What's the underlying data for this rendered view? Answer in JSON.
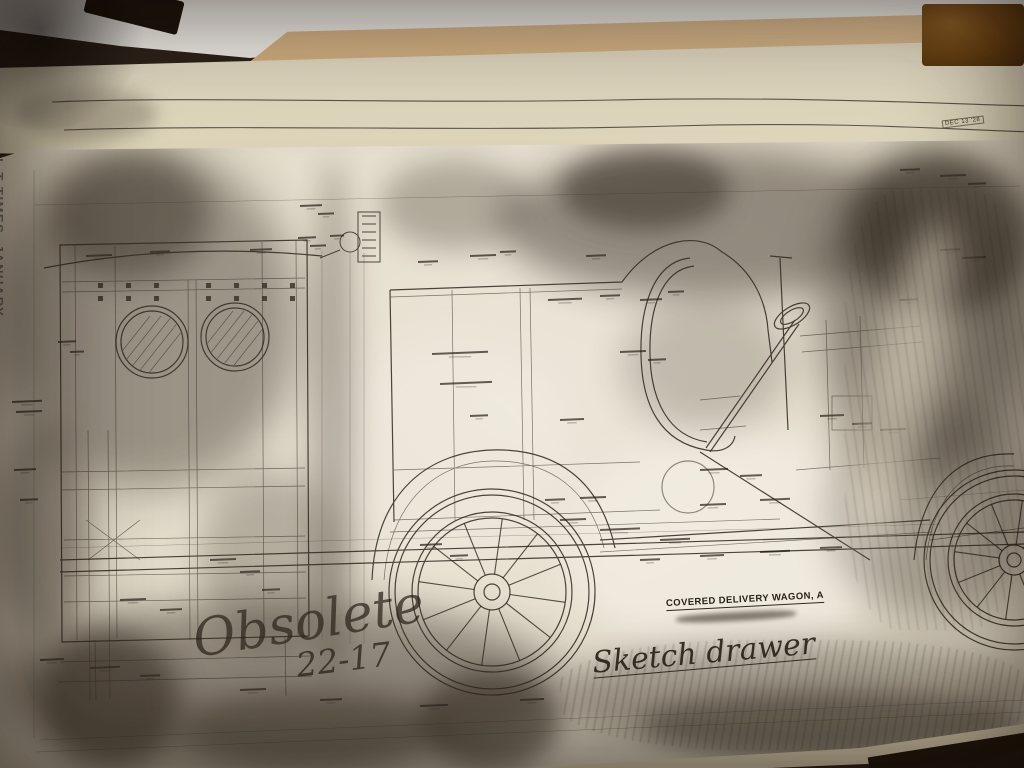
{
  "texts": {
    "page_margin_vertical": "EL T TIMES. JANUARY",
    "date_stamp": "DEC 13 '28",
    "drawing_title": "COVERED DELIVERY WAGON, A",
    "handwritten_obsolete": "Obsolete",
    "handwritten_date": "22-17",
    "handwritten_note": "Sketch drawer"
  },
  "colors": {
    "table_brown": "#2b211a",
    "white_paper": "#f8f6f3",
    "kraft_paper": "#ddba8e",
    "cream_sheet": "#e9e1c9",
    "print_paper": "#ece6d8",
    "ink": "#2f2922",
    "smudge": "#342c24"
  }
}
